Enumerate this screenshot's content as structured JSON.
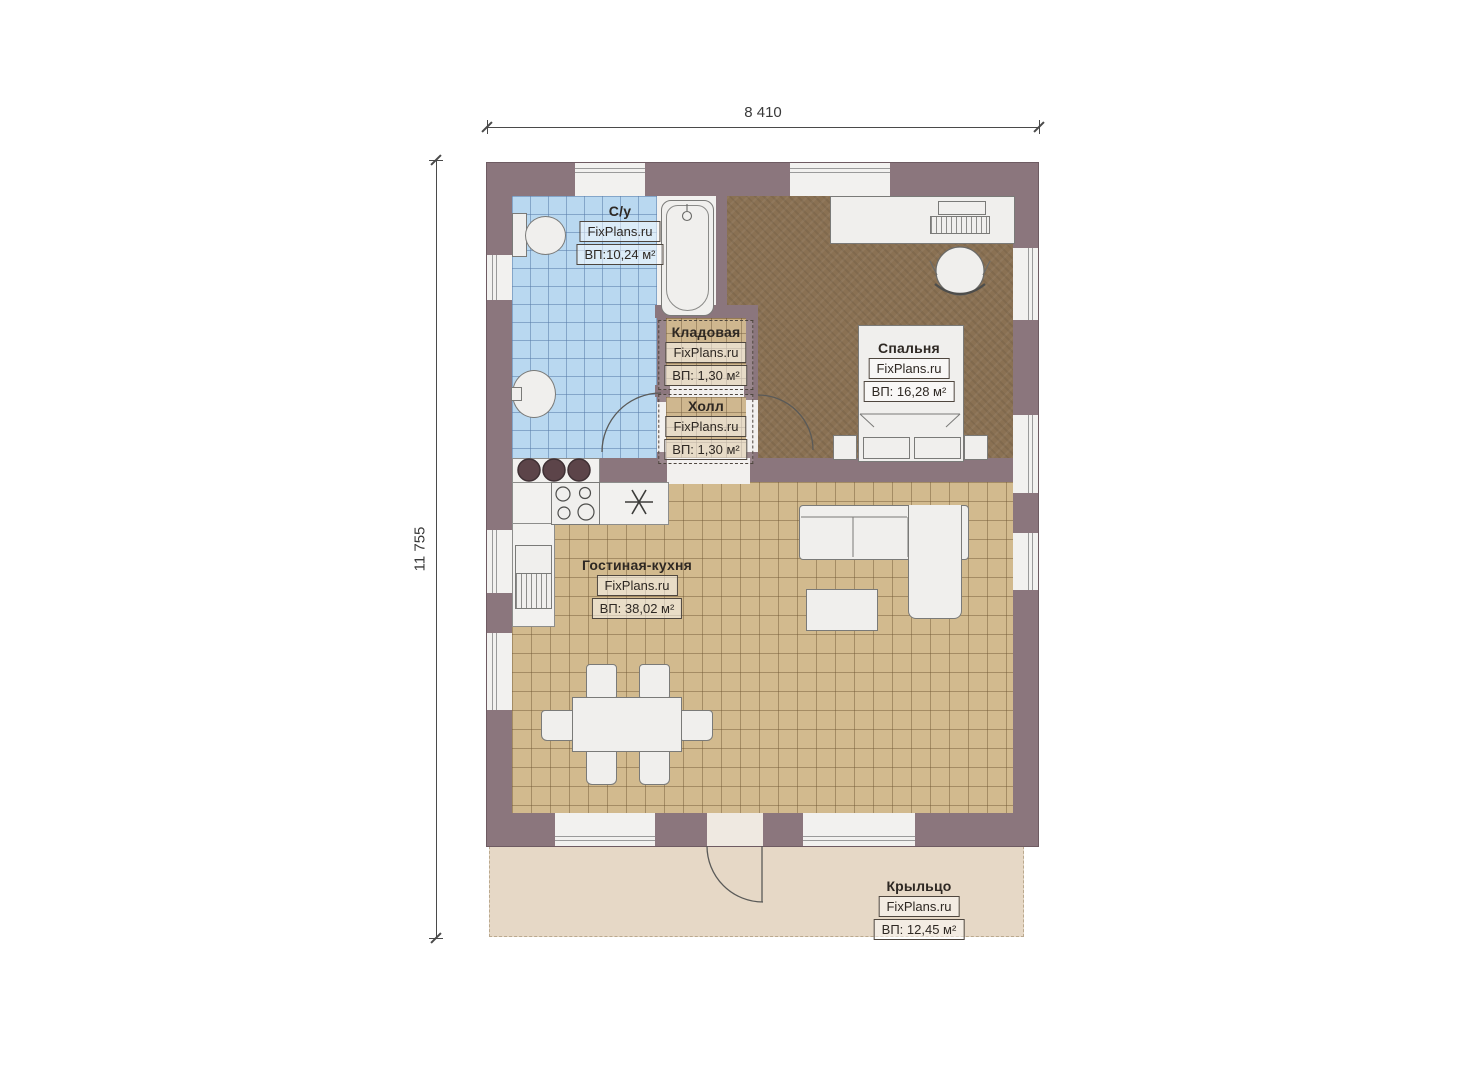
{
  "plan": {
    "dimension_width": "8 410",
    "dimension_height": "11 755"
  },
  "rooms": {
    "bathroom": {
      "name": "С/у",
      "brand": "FixPlans.ru",
      "area": "ВП:10,24 м²"
    },
    "storage": {
      "name": "Кладовая",
      "brand": "FixPlans.ru",
      "area": "ВП: 1,30 м²"
    },
    "hall": {
      "name": "Холл",
      "brand": "FixPlans.ru",
      "area": "ВП: 1,30 м²"
    },
    "bedroom": {
      "name": "Спальня",
      "brand": "FixPlans.ru",
      "area": "ВП: 16,28 м²"
    },
    "living": {
      "name": "Гостиная-кухня",
      "brand": "FixPlans.ru",
      "area": "ВП: 38,02 м²"
    },
    "porch": {
      "name": "Крыльцо",
      "brand": "FixPlans.ru",
      "area": "ВП: 12,45 м²"
    }
  },
  "colors": {
    "wall": "#8b767d",
    "bathroom_floor": "#b9d8f0",
    "living_floor": "#d2ba8e",
    "hall_floor": "#c9ad80",
    "bedroom_floor": "#8a7153",
    "porch_floor": "#e6d8c6",
    "furniture": "#f0efed"
  }
}
